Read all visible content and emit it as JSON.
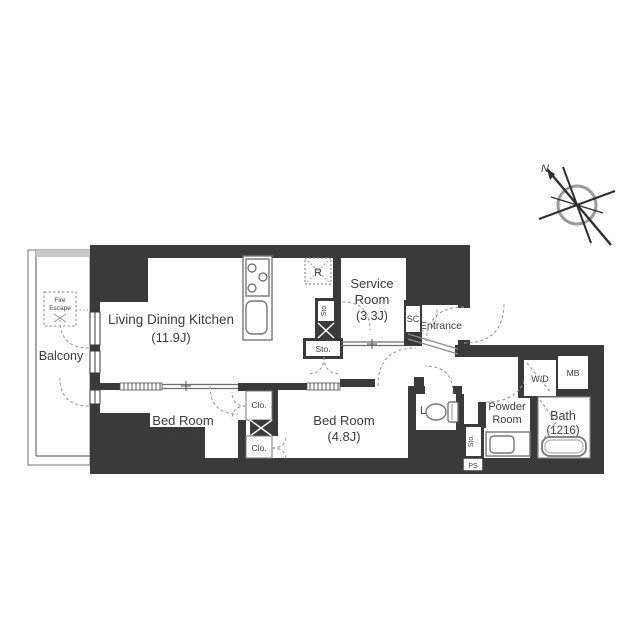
{
  "colors": {
    "wall": "#3a3a3a",
    "text": "#3c3c3c",
    "balcony_edge": "#c9c9c9",
    "dashed_line": "#9a9a9a"
  },
  "compass": {
    "north_label": "N"
  },
  "rooms": {
    "balcony": {
      "label": "Balcony"
    },
    "ldk": {
      "label": "Living Dining Kitchen",
      "size": "(11.9J)"
    },
    "service_room": {
      "label_line1": "Service",
      "label_line2": "Room",
      "size": "(3.3J)"
    },
    "bedroom_1": {
      "label": "Bed Room",
      "size": "(5.0J)"
    },
    "bedroom_2": {
      "label": "Bed Room",
      "size": "(4.8J)"
    },
    "entrance": {
      "label": "Entrance"
    },
    "powder_room": {
      "label_line1": "Powder",
      "label_line2": "Room"
    },
    "bath": {
      "label": "Bath",
      "size": "(1216)"
    },
    "lavatory": {
      "label": "Lav."
    }
  },
  "fixtures": {
    "refrigerator_space": "R",
    "shoe_closet": "SC",
    "storage_kitchen_small": "Sto",
    "storage_kitchen_closet": "Sto.",
    "storage_powder": "Sto.",
    "pipe_space": "PS",
    "closet_upper": "Clo.",
    "closet_lower": "Clo.",
    "washer_dryer": "W/D",
    "meter_box": "MB",
    "fire_escape_line1": "Fire",
    "fire_escape_line2": "Escape"
  }
}
